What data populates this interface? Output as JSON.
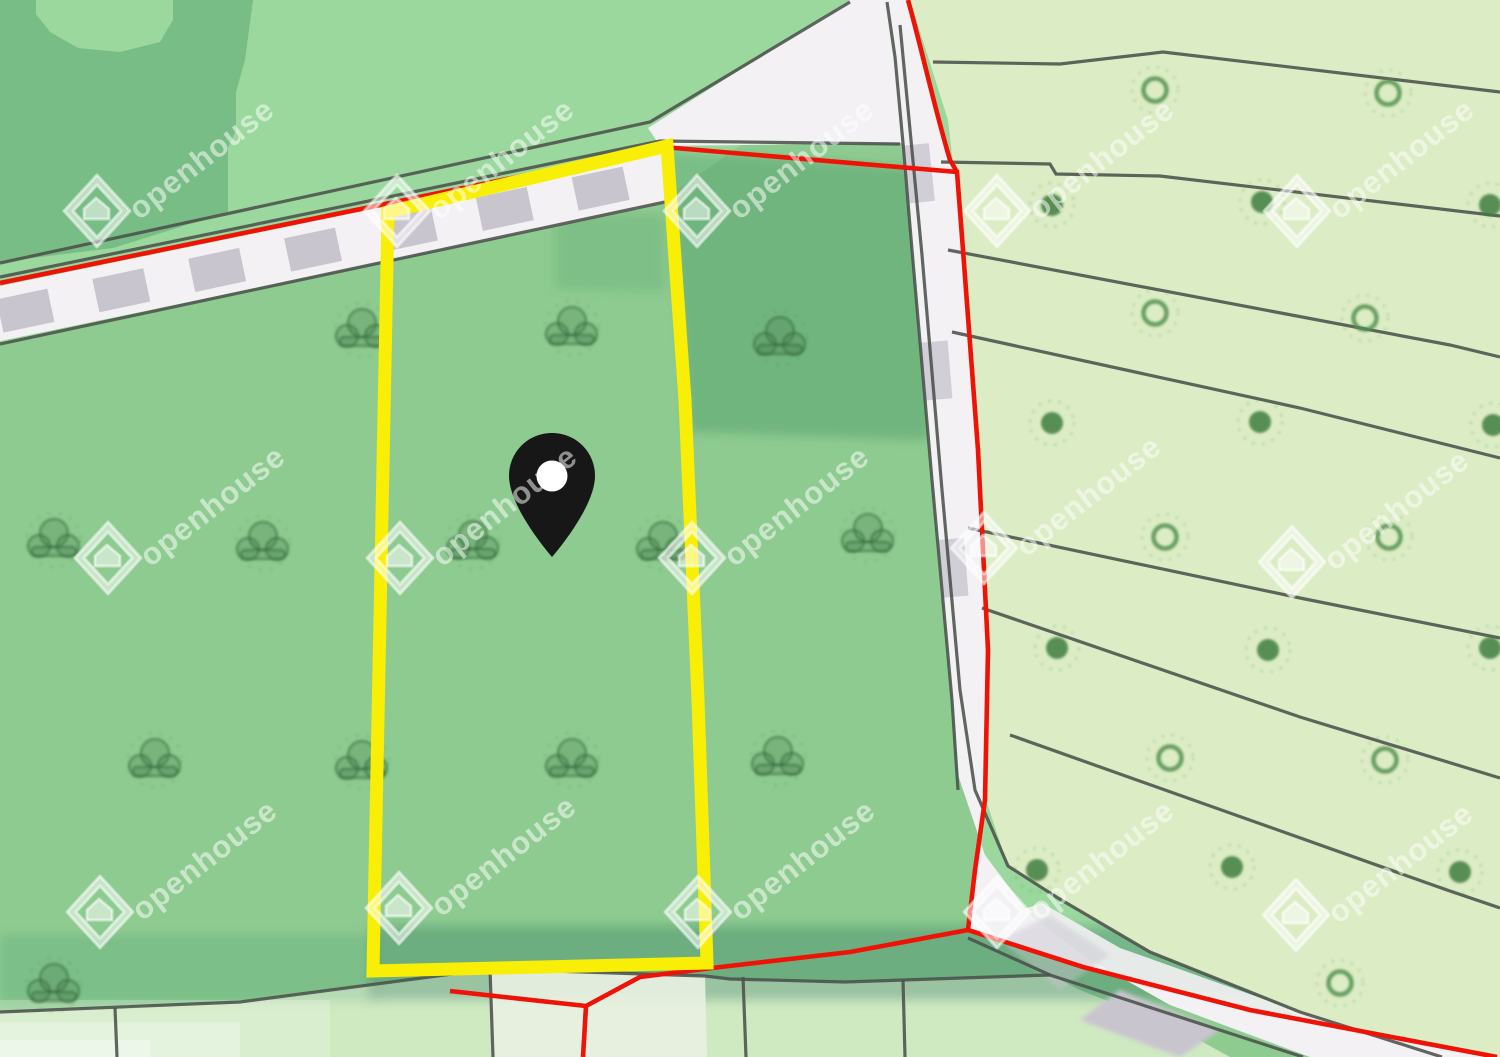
{
  "map": {
    "description": "cadastral parcel map with highlighted plot",
    "marker": {
      "x": 552,
      "y": 495
    },
    "highlighted_parcel": {
      "points": "388,212 667,146 685,400 698,700 707,963 373,971"
    },
    "symbols": {
      "bushes": [
        [
          362,
          330
        ],
        [
          572,
          328
        ],
        [
          780,
          338
        ],
        [
          54,
          540
        ],
        [
          263,
          543
        ],
        [
          473,
          542
        ],
        [
          663,
          543
        ],
        [
          868,
          535
        ],
        [
          155,
          760
        ],
        [
          362,
          762
        ],
        [
          572,
          760
        ],
        [
          778,
          758
        ],
        [
          54,
          985
        ]
      ],
      "rings": [
        [
          1155,
          90
        ],
        [
          1388,
          93
        ],
        [
          1155,
          313
        ],
        [
          1365,
          318
        ],
        [
          1165,
          537
        ],
        [
          1389,
          537
        ],
        [
          1170,
          758
        ],
        [
          1385,
          760
        ],
        [
          1340,
          983
        ]
      ],
      "dots": [
        [
          1052,
          205
        ],
        [
          1262,
          202
        ],
        [
          1490,
          205
        ],
        [
          1052,
          423
        ],
        [
          1260,
          422
        ],
        [
          1493,
          425
        ],
        [
          1057,
          648
        ],
        [
          1268,
          650
        ],
        [
          1490,
          648
        ],
        [
          1037,
          870
        ],
        [
          1232,
          867
        ],
        [
          1460,
          872
        ]
      ]
    }
  },
  "watermark": {
    "text": "openhouse",
    "positions": [
      [
        97,
        211
      ],
      [
        397,
        211
      ],
      [
        697,
        211
      ],
      [
        997,
        211
      ],
      [
        1297,
        211
      ],
      [
        108,
        558
      ],
      [
        400,
        558
      ],
      [
        692,
        558
      ],
      [
        984,
        548
      ],
      [
        1292,
        562
      ],
      [
        100,
        912
      ],
      [
        399,
        908
      ],
      [
        698,
        912
      ],
      [
        997,
        912
      ],
      [
        1296,
        915
      ]
    ]
  },
  "colors": {
    "top-green": "#9bd89d",
    "field": "#8ecb90",
    "patch": "#77bd85",
    "orchard": "#dcedc5",
    "strip": "#cfe9c1",
    "strip-pale": "#e9f1e2",
    "road": "#f3f1f4",
    "dash": "#c9c5cf",
    "line": "#4b514b",
    "red": "#ee1306",
    "yellow": "#f9ee06",
    "pin": "#171717",
    "ring": "#549150",
    "dot": "#3f7e3e",
    "wm": "rgba(255,255,255,0.52)"
  }
}
